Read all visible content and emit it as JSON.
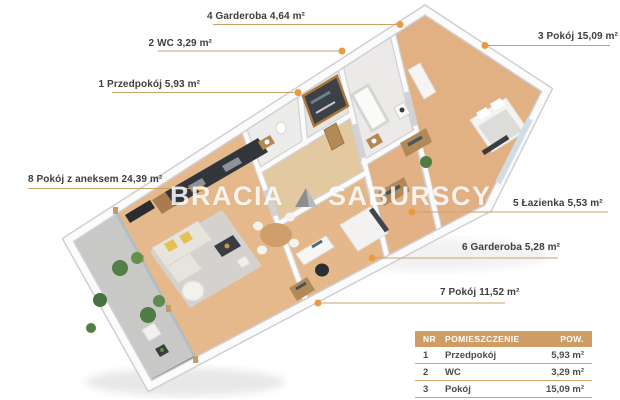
{
  "watermark": {
    "word1": "BRACIA",
    "word2": "SABURSCY"
  },
  "room_labels": {
    "l1": "1 Przedpokój 5,93 m²",
    "l2": "2 WC 3,29 m²",
    "l3": "3 Pokój 15,09 m²",
    "l4": "4 Garderoba 4,64 m²",
    "l5": "5 Łazienka 5,53 m²",
    "l6": "6 Garderoba 5,28 m²",
    "l7": "7 Pokój 11,52 m²",
    "l8": "8 Pokój z aneksem 24,39 m²"
  },
  "legend": {
    "headers": {
      "nr": "NR",
      "room": "POMIESZCZENIE",
      "area": "POW."
    },
    "rows": [
      {
        "nr": "1",
        "room": "Przedpokój",
        "area": "5,93 m²"
      },
      {
        "nr": "2",
        "room": "WC",
        "area": "3,29 m²"
      },
      {
        "nr": "3",
        "room": "Pokój",
        "area": "15,09 m²"
      },
      {
        "nr": "4",
        "room": "Garderoba",
        "area": "4,64 m²"
      }
    ]
  },
  "colors": {
    "leader_line": "#c9a168",
    "marker_dot": "#ec9a3f",
    "legend_header_bg": "#d09c66",
    "legend_text": "#4b4b4b",
    "label_text": "#3e3e3e",
    "wood_floor": "#e5b98b",
    "wall_white": "#fbfbfc"
  }
}
